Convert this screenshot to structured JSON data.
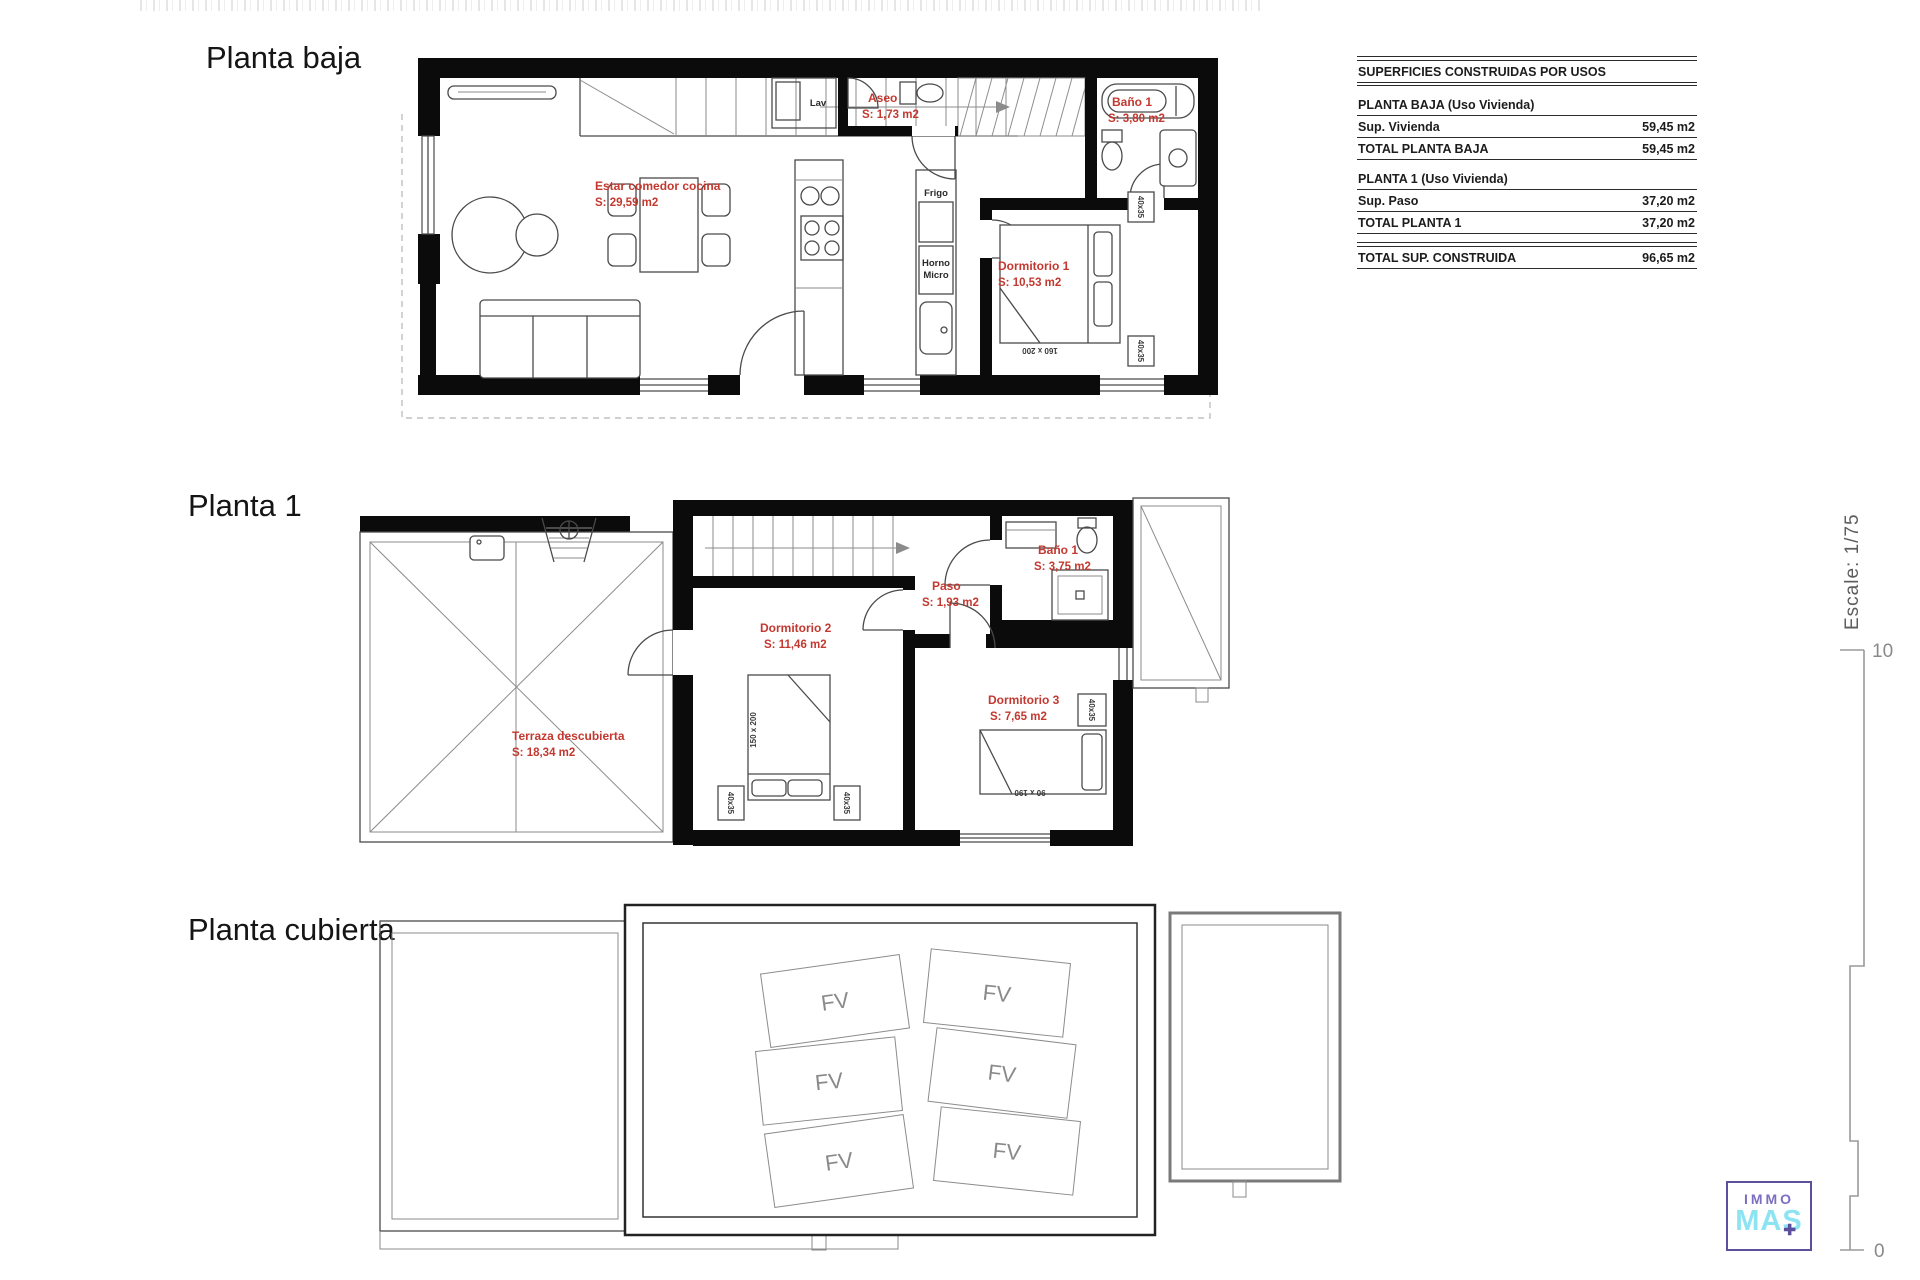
{
  "titles": {
    "floor0": "Planta baja",
    "floor1": "Planta 1",
    "floor2": "Planta cubierta"
  },
  "plans": {
    "baja": {
      "rooms": {
        "estar": {
          "name": "Estar comedor cocina",
          "area": "S: 29,59 m2"
        },
        "aseo": {
          "name": "Aseo",
          "area": "S: 1,73 m2"
        },
        "bano1": {
          "name": "Baño 1",
          "area": "S: 3,80 m2"
        },
        "dorm1": {
          "name": "Dormitorio 1",
          "area": "S: 10,53 m2"
        }
      },
      "labels": {
        "lav": "Lav",
        "frigo": "Frigo",
        "horno": "Horno",
        "micro": "Micro",
        "bed_dim": "160 x 200",
        "nightstand": "40x35"
      }
    },
    "p1": {
      "rooms": {
        "terraza": {
          "name": "Terraza descubierta",
          "area": "S: 18,34 m2"
        },
        "dorm2": {
          "name": "Dormitorio 2",
          "area": "S: 11,46 m2"
        },
        "paso": {
          "name": "Paso",
          "area": "S: 1,93 m2"
        },
        "bano1": {
          "name": "Baño 1",
          "area": "S: 3,75 m2"
        },
        "dorm3": {
          "name": "Dormitorio 3",
          "area": "S: 7,65 m2"
        }
      },
      "labels": {
        "bed2_dim": "150 x 200",
        "bed3_dim": "90 x 190",
        "nightstand": "40x35"
      }
    },
    "cubierta": {
      "panel": "FV"
    }
  },
  "areas_table": {
    "title": "SUPERFICIES CONSTRUIDAS POR USOS",
    "s1_header": "PLANTA BAJA (Uso Vivienda)",
    "s1_row_label": "Sup. Vivienda",
    "s1_row_value": "59,45 m2",
    "s1_total_label": "TOTAL PLANTA BAJA",
    "s1_total_value": "59,45 m2",
    "s2_header": "PLANTA 1 (Uso Vivienda)",
    "s2_row_label": "Sup. Paso",
    "s2_row_value": "37,20 m2",
    "s2_total_label": "TOTAL PLANTA 1",
    "s2_total_value": "37,20 m2",
    "grand_label": "TOTAL SUP. CONSTRUIDA",
    "grand_value": "96,65 m2"
  },
  "scalebar": {
    "label": "Escale: 1/75",
    "top": "10",
    "bottom": "0"
  },
  "logo": {
    "top": "IMMO",
    "bottom": "MAS",
    "plus": "✚"
  }
}
